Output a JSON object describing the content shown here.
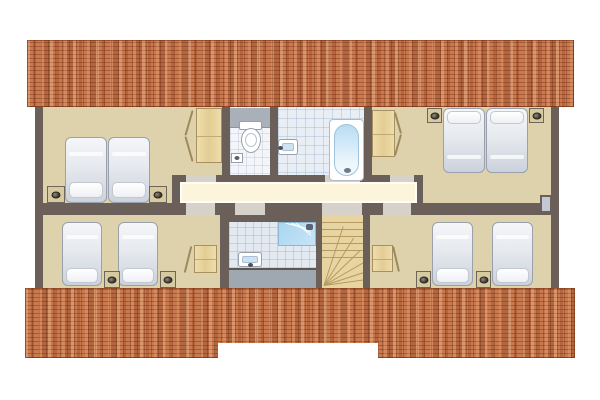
{
  "scene": {
    "kind": "floor-plan",
    "view": "top-down",
    "text_visible": false
  },
  "colors": {
    "roof_tile": "#c97a4e",
    "wall": "#6b6059",
    "bedroom_floor": "#ddd2ab",
    "hallway_floor": "#fcf5db",
    "bathroom_tile": "#e9eef4",
    "wc_tile": "#f3f5f9",
    "shower_tile": "#e2e9f0",
    "stair_wood": "#e8d4a1",
    "furniture_wood": "#ead9a6",
    "mattress_gray": "#dfe3ea",
    "fixture_gray": "#9fa8b1",
    "shower_blue": "#aed7f0",
    "tub_blue": "#bfdff4"
  },
  "rooms": {
    "bedroom_top_left": "bedroom-top-left",
    "wc": "wc",
    "bathroom": "bathroom",
    "bedroom_top_right": "bedroom-top-right",
    "hallway": "hallway",
    "bedroom_bottom_left": "bedroom-bottom-left",
    "shower_room": "shower-room",
    "staircase": "staircase",
    "bedroom_bottom_right": "bedroom-bottom-right"
  },
  "fixtures": {
    "double_beds": 2,
    "single_beds": 4,
    "wardrobes": 4,
    "nightstands": 8,
    "toilets": 1,
    "bathtubs": 1,
    "washbasins": 2,
    "showers": 1,
    "staircases": 1
  }
}
